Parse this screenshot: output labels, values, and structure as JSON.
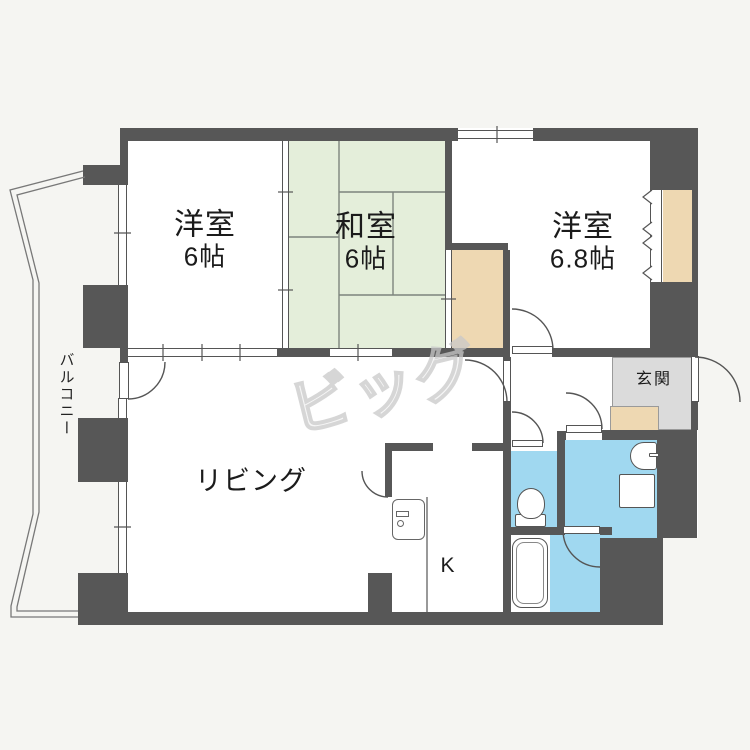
{
  "title": "間取り図",
  "rooms": {
    "western1": {
      "label": "洋室",
      "size": "6帖"
    },
    "japanese": {
      "label": "和室",
      "size": "6帖"
    },
    "western2": {
      "label": "洋室",
      "size": "6.8帖"
    },
    "living": {
      "label": "リビング"
    },
    "kitchen": {
      "label": "K"
    },
    "entrance": {
      "label": "玄関"
    },
    "balcony": {
      "label": "バルコニー"
    }
  },
  "watermark": {
    "text": "ビッグ"
  },
  "fixtures": [
    "toilet",
    "bathtub",
    "sink",
    "washing-machine",
    "refrigerator"
  ],
  "colors": {
    "bg": "#f5f5f2",
    "floor": "#ffffff",
    "wall": "#575757",
    "line": "#555555",
    "tatami": "#e4eeda",
    "tatamiLine": "#7d847d",
    "closet": "#eed8b2",
    "water": "#a0d8f0",
    "genkan": "#dbdbdb",
    "mark": "#c9c9c9"
  }
}
